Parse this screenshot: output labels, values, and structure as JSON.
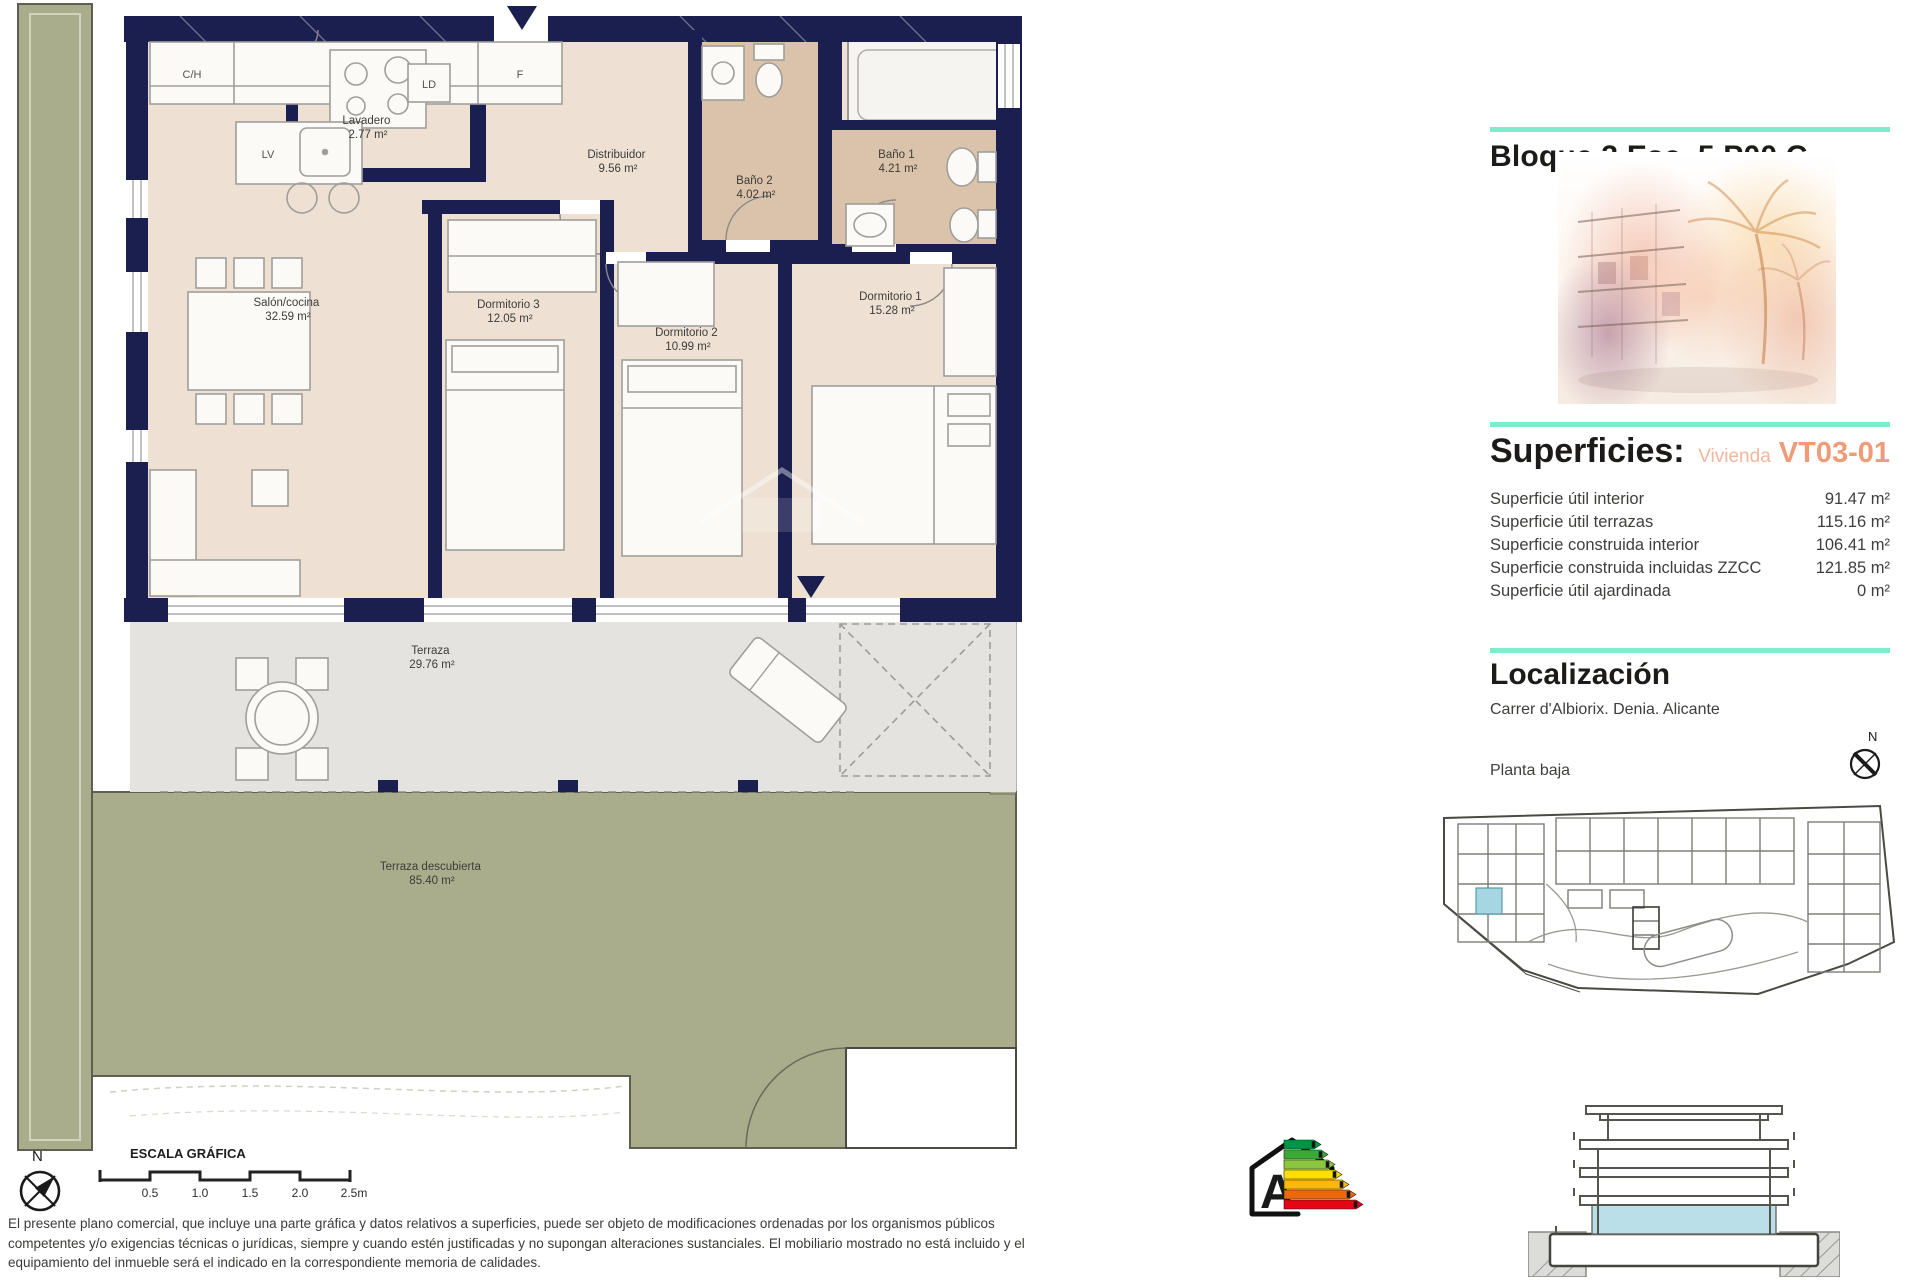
{
  "header": {
    "title": "Bloque 3 Esc. 5 P00 C"
  },
  "superficies": {
    "title": "Superficies:",
    "vivienda_label": "Vivienda",
    "vivienda_code": "VT03-01",
    "rows": [
      {
        "label": "Superficie útil interior",
        "value": "91.47 m²"
      },
      {
        "label": "Superficie útil terrazas",
        "value": "115.16 m²"
      },
      {
        "label": "Superficie construida interior",
        "value": "106.41 m²"
      },
      {
        "label": "Superficie construida incluidas ZZCC",
        "value": "121.85 m²"
      },
      {
        "label": "Superficie útil ajardinada",
        "value": "0 m²"
      }
    ]
  },
  "localizacion": {
    "title": "Localización",
    "address": "Carrer d'Albiorix. Denia. Alicante",
    "floor_label": "Planta baja"
  },
  "plan": {
    "rooms": [
      {
        "name": "Salón/cocina",
        "area": "32.59 m²"
      },
      {
        "name": "Dormitorio 3",
        "area": "12.05 m²"
      },
      {
        "name": "Dormitorio 2",
        "area": "10.99 m²"
      },
      {
        "name": "Dormitorio 1",
        "area": "15.28 m²"
      },
      {
        "name": "Lavadero",
        "area": "2.77 m²"
      },
      {
        "name": "Distribuidor",
        "area": "9.56 m²"
      },
      {
        "name": "Baño 2",
        "area": "4.02 m²"
      },
      {
        "name": "Baño 1",
        "area": "4.21 m²"
      },
      {
        "name": "Terraza",
        "area": "29.76 m²"
      },
      {
        "name": "Terraza descubierta",
        "area": "85.40 m²"
      }
    ],
    "kitchen": {
      "ch": "C/H",
      "f": "F",
      "lv": "LV",
      "ld": "LD"
    }
  },
  "scale": {
    "title": "ESCALA GRÁFICA",
    "ticks": [
      "0.5",
      "1.0",
      "1.5",
      "2.0",
      "2.5m"
    ]
  },
  "compass": {
    "label": "N"
  },
  "energy": {
    "letter": "A",
    "colors": [
      "#009640",
      "#3aaa35",
      "#8cc63f",
      "#ffde00",
      "#fbba00",
      "#eb690b",
      "#e30613"
    ]
  },
  "disclaimer": "El presente plano comercial, que incluye una parte gráfica y datos relativos a superficies, puede ser objeto de modificaciones ordenadas por los organismos públicos competentes y/o exigencias técnicas o jurídicas, siempre y cuando estén justificadas y no supongan alteraciones sustanciales. El mobiliario mostrado no está incluido y el equipamiento del inmueble será el indicado en la correspondiente memoria de calidades.",
  "colors": {
    "wall_navy": "#1a1f4f",
    "floor_beige": "#eee1d4",
    "bath_tan": "#dbc3ab",
    "terrace_grey": "#e4e3e0",
    "garden_olive": "#a9ad8b",
    "accent_mint": "#7febcd",
    "vivienda_salmon": "#ef9b78",
    "highlight_blue": "#a5d6e2",
    "section_blue": "#badfe8"
  }
}
